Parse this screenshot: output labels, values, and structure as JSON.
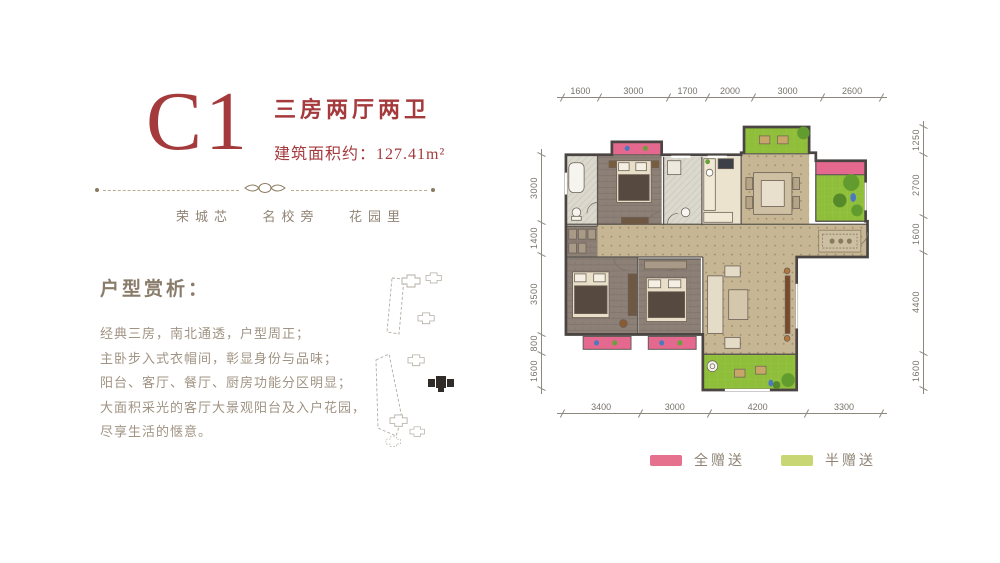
{
  "header": {
    "unit_code": "C1",
    "type_label": "三房两厅两卫",
    "area_label": "建筑面积约：127.41m²"
  },
  "tagline": {
    "items": [
      "荣城芯",
      "名校旁",
      "花园里"
    ]
  },
  "analysis": {
    "heading": "户型赏析：",
    "lines": [
      "经典三房，南北通透，户型周正；",
      "主卧步入式衣帽间，彰显身份与品味；",
      "阳台、客厅、餐厅、厨房功能分区明显；",
      "大面积采光的客厅大景观阳台及入户花园，",
      "尽享生活的惬意。"
    ]
  },
  "floorplan": {
    "dimensions": {
      "top": [
        "1600",
        "3000",
        "1700",
        "2000",
        "3000",
        "2600"
      ],
      "bottom": [
        "3400",
        "3000",
        "4200",
        "3300"
      ],
      "left": [
        "3000",
        "1400",
        "3500",
        "800",
        "1600"
      ],
      "right": [
        "1250",
        "2700",
        "1600",
        "4400",
        "1600"
      ]
    },
    "legend": [
      {
        "label": "全赠送",
        "color": "#e5718f"
      },
      {
        "label": "半赠送",
        "color": "#c9d674"
      }
    ],
    "rooms": [
      "主卧",
      "卫生间",
      "卫生间",
      "厨房",
      "餐厅",
      "客厅",
      "卧室",
      "卧室",
      "衣帽间",
      "入户花园",
      "阳台"
    ]
  },
  "colors": {
    "accent_red": "#a53a3c",
    "text_brown": "#a09383",
    "gift_full_pink": "#e5718f",
    "gift_half_green": "#c9d674",
    "garden_green": "#8fbe3a",
    "floor_tan": "#c7b694",
    "wall_dark": "#4a4542"
  }
}
